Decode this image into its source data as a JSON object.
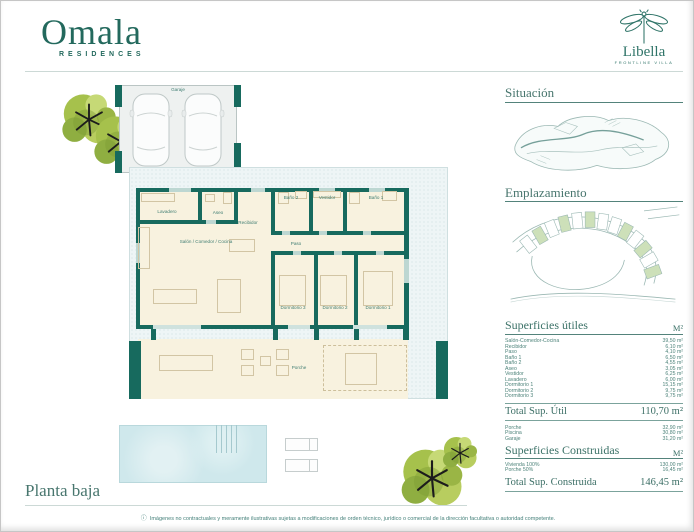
{
  "brand": {
    "name": "Omala",
    "tagline": "RESIDENCES"
  },
  "product": {
    "name": "Libella",
    "tagline": "FRONTLINE VILLA"
  },
  "plan": {
    "garage_label": "Garaje",
    "rooms": [
      "Lavadero",
      "Aseo",
      "Recibidor",
      "Baño 2",
      "Vestidor",
      "Baño 1",
      "Salón / Comedor / Cocina",
      "Paso",
      "Dormitorio 3",
      "Dormitorio 2",
      "Dormitorio 1"
    ],
    "porch_label": "Porche",
    "title": "Planta baja"
  },
  "sidebar": {
    "situacion_title": "Situación",
    "emplazamiento_title": "Emplazamiento",
    "utiles": {
      "title": "Superficies útiles",
      "unit": "M²",
      "rows": [
        {
          "label": "Salón-Comedor-Cocina",
          "value": "39,50 m²"
        },
        {
          "label": "Recibidor",
          "value": "6,10 m²"
        },
        {
          "label": "Paso",
          "value": "4,10 m²"
        },
        {
          "label": "Baño 1",
          "value": "6,50 m²"
        },
        {
          "label": "Baño 2",
          "value": "4,55 m²"
        },
        {
          "label": "Aseo",
          "value": "3,05 m²"
        },
        {
          "label": "Vestidor",
          "value": "6,25 m²"
        },
        {
          "label": "Lavadero",
          "value": "6,00 m²"
        },
        {
          "label": "Dormitorio 1",
          "value": "15,15 m²"
        },
        {
          "label": "Dormitorio 2",
          "value": "9,75 m²"
        },
        {
          "label": "Dormitorio 3",
          "value": "9,75 m²"
        }
      ],
      "total_label": "Total Sup. Útil",
      "total_value": "110,70 m²"
    },
    "exterior": {
      "rows": [
        {
          "label": "Porche",
          "value": "32,90 m²"
        },
        {
          "label": "Piscina",
          "value": "30,80 m²"
        },
        {
          "label": "Garaje",
          "value": "31,20 m²"
        }
      ]
    },
    "construidas": {
      "title": "Superficies Construidas",
      "unit": "M²",
      "rows": [
        {
          "label": "Vivienda 100%",
          "value": "130,00 m²"
        },
        {
          "label": "Porche 50%",
          "value": "16,45 m²"
        }
      ],
      "total_label": "Total Sup. Construida",
      "total_value": "146,45 m²"
    }
  },
  "footer": {
    "info_glyph": "ⓘ",
    "disclaimer": "Imágenes no contractuales y meramente ilustrativas sujetas a modificaciones de orden técnico, jurídico o comercial de la dirección facultativa o autoridad competente."
  }
}
